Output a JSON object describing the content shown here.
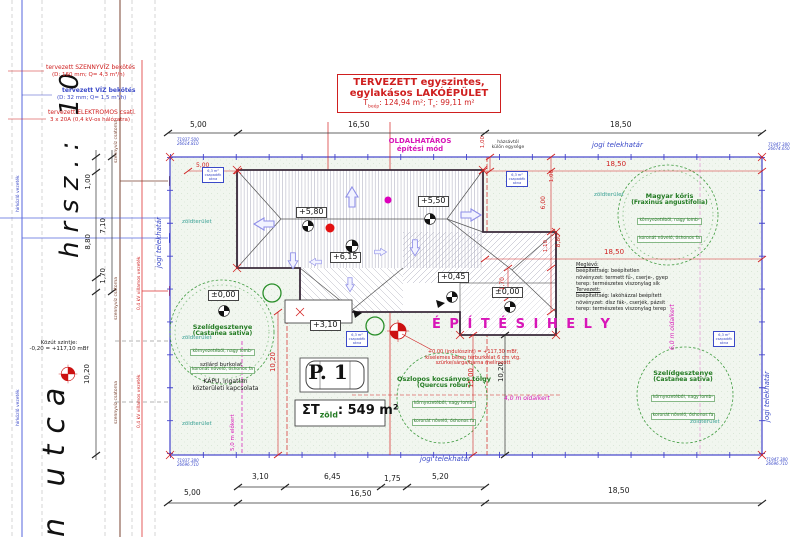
{
  "parcel": {
    "hrsz": "hrsz.: 10",
    "street": "n utca"
  },
  "notes": {
    "szennyviz1": "tervezett SZENNYVÍZ bekötés",
    "szennyviz2": "(D: 160 mm; Q= 4,3 m³/h)",
    "viz1": "tervezett VÍZ bekötés",
    "viz2": "(D: 32 mm; Q= 1,5 m³/h)",
    "elektromos1": "tervezett ELEKTROMOS csatl.",
    "elektromos2": "3 x 20A (0,4 kV-os hálózatra)"
  },
  "title_box": {
    "line1": "TERVEZETT egyszintes,",
    "line2": "egylakásos LAKÓÉPÜLET",
    "area_t1": "T",
    "area_s1": "beép",
    "area_m": ": 124,94 m²;  T",
    "area_s2": "n",
    "area_e": ": 99,11 m²"
  },
  "mode": {
    "line1": "OLDALHATÁROS",
    "line2": "építési mód"
  },
  "house_gap": {
    "line1": "házsávtól",
    "line2": "külön egysége"
  },
  "boundary": {
    "label": "jogi telekhatár"
  },
  "coords": {
    "tl1": "71937.500",
    "tl2": "26614.810",
    "tr1": "71947.380",
    "tr2": "26674.650",
    "bl1": "71937.380",
    "bl2": "26696.710",
    "br1": "71947.380",
    "br2": "26696.710"
  },
  "levels": {
    "l580": "+5,80",
    "l550": "+5,50",
    "l615": "+6,15",
    "l045": "+0,45",
    "l000a": "±0,00",
    "l000b": "±0,00",
    "l310": "+3,10"
  },
  "dims": {
    "top1": "5,00",
    "top2": "16,50",
    "top3": "18,50",
    "b11": "3,10",
    "b12": "6,45",
    "b13": "1,75",
    "b14": "5,20",
    "b21": "5,00",
    "b22": "16,50",
    "b23": "18,50",
    "l1": "1,00",
    "l2": "7,10",
    "l3": "8,80",
    "l4": "1,70",
    "l5": "10,20",
    "r1": "18,50",
    "r2": "18,50",
    "r3": "1,00",
    "r4": "1,00",
    "r5": "6,00",
    "r6": "1,10",
    "r7": "8,80",
    "r8": "1,70",
    "r9": "10,20",
    "r10": "15,00",
    "r11": "10,20",
    "r12": "5,00"
  },
  "green": {
    "zoldterulet": "zöldterület",
    "total_sigma": "ΣT",
    "total_sub": "zöld",
    "total_rest": ": 549 m²"
  },
  "site_text": {
    "epitesihely": "É P Í T É S I H E L Y",
    "elokert": "5,0 m előkert",
    "oldalkert4": "4,0 m oldalkert",
    "oldalkert6": "6,0 m oldalkert",
    "szilard": "szilárd burkolat",
    "kapu1": "KAPU, ingatlan",
    "kapu2": "közterületi kapcsolata",
    "kozut1": "Közút szintje:",
    "kozut2": "-0,20 = +117,10 mBf",
    "start1": "+0,00 (indulószint) = +117,30 mBf,",
    "start2": "kiselemes beton térburkolat 6 cm vtg.",
    "start3": "szürke/sárga/barna melírozott",
    "parking": "P. 1"
  },
  "utilities": {
    "szennyviz": "szennyvíz csatorna",
    "hirkozlo": "hírközlő vezeték",
    "villamos": "0,4 kV villamos vezeték"
  },
  "trees": {
    "chestnut": {
      "name": "Szelídgesztenye",
      "latin": "(Castanea sativa)",
      "d1": "környezetéből, nagy lomb-",
      "d2": "koronát növelő, őshonos fa"
    },
    "ash": {
      "name": "Magyar kőris",
      "latin": "(Fraxinus angustifolia)",
      "d1": "környezetéből, nagy lomb-",
      "d2": "koronát növelő, őshonos fa"
    },
    "oak": {
      "name": "Oszlopos kocsányos tölgy",
      "latin": "(Quercus robur)",
      "d1": "környezetéből, nagy lomb-",
      "d2": "koronát növelő, őshonos fa"
    }
  },
  "land_use": {
    "h1": "Meglévő:",
    "l1": "beépítettség: beépítetlen",
    "l2": "növényzet: termett fű-, cserje-, gyep",
    "l3": "terep: természetes viszonylag sík",
    "h2": "Tervezett:",
    "l4": "beépítettség: lakóházzal beépített",
    "l5": "növényzet: dísz fák-, cserjék, pázsit",
    "l6": "terep: természetes viszonylag terep"
  },
  "marker_box": {
    "l1": "6,3 m²",
    "l2": "csapadék",
    "l3": "akna"
  },
  "colors": {
    "boundary_blue": "#4444cc",
    "magenta": "#d816b8",
    "red": "#cf1f1f",
    "tree_green": "#227a22",
    "teal": "#3aa195",
    "brown": "#7a4330"
  }
}
